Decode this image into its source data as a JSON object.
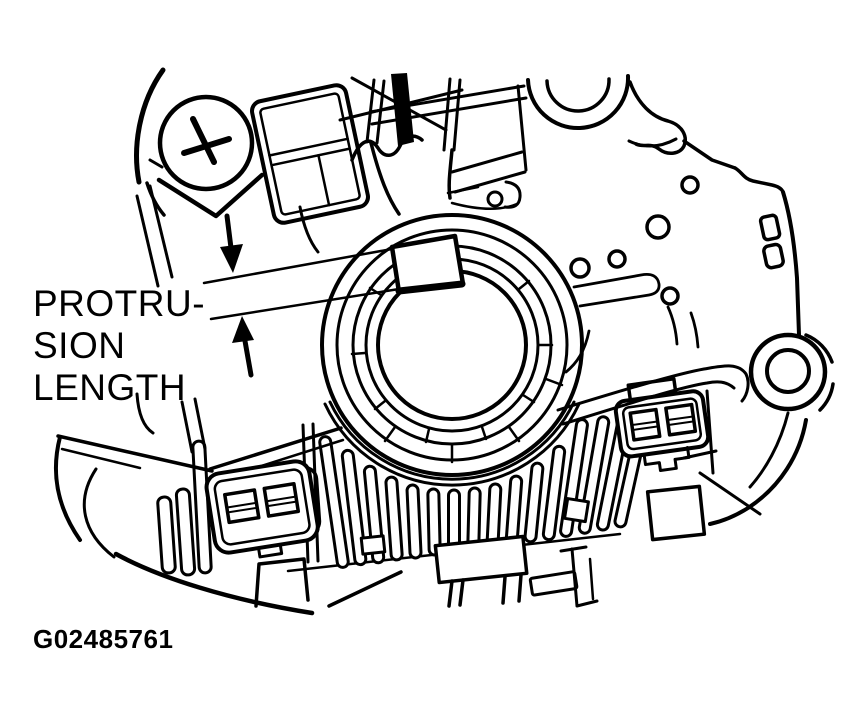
{
  "figure": {
    "callout": {
      "line1": "PROTRU-",
      "line2": "SION",
      "line3": "LENGTH"
    },
    "figure_id": "G02485761"
  },
  "colors": {
    "ink": "#000000",
    "paper": "#ffffff"
  }
}
